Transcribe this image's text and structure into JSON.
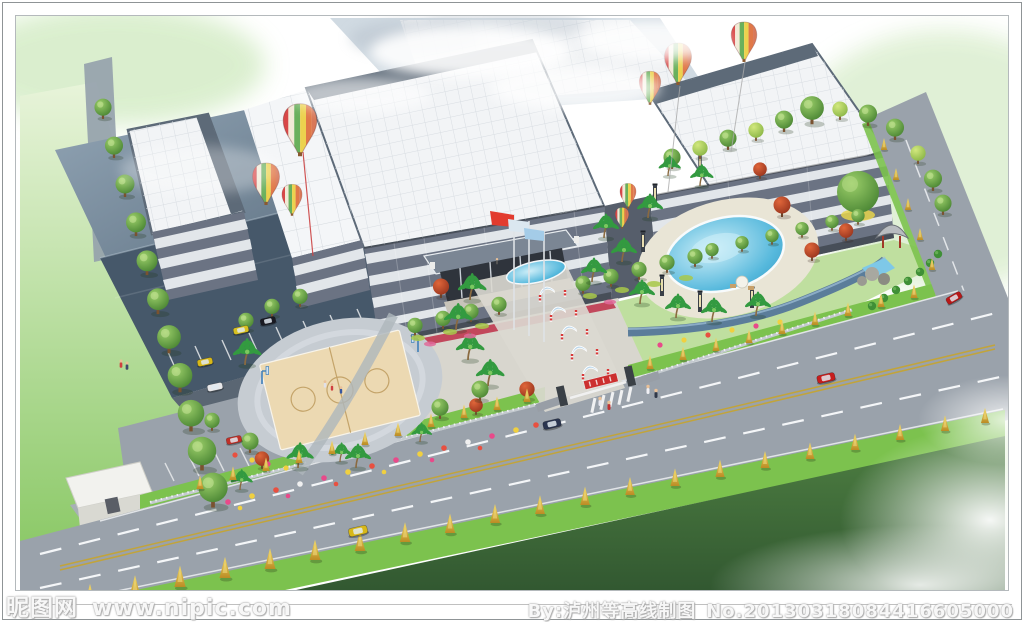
{
  "image": {
    "kind": "architectural aerial rendering of a factory campus with landscaped gardens",
    "width": 1024,
    "height": 622
  },
  "watermark": {
    "left_brand": "昵图网",
    "left_url": "www.nipic.com",
    "right_credit": "By:泸州等高线制图",
    "right_serial": "No.20130318084416605000"
  },
  "scene": {
    "elements": [
      "white panel factory roofs with dark parapets",
      "dark slate warehouse roofs (top left)",
      "five-story office facade with glass bands and entrance portico",
      "flag poles with red and light-blue flags",
      "striped hot-air balloon decorations",
      "central landscaped axis with oval fountain pond, arches and bollard lamps",
      "circular basketball court plaza with two hoops",
      "swimming pool garden with palms, red maples, gazebo and rockery",
      "parking lot with parked cars and stall lines",
      "white gatehouse at site entrance",
      "perimeter rows of round green trees",
      "main road with yellow center line, white dashes, cars and pedestrians",
      "green verges with yellow columnar trees",
      "dark green embankment fading into mist"
    ],
    "colors": {
      "background": "#ffffff",
      "sky_green": "#d6ecc6",
      "slate_roof": "#4c5f70",
      "panel_roof": "#f2f4f6",
      "roof_frame": "#5d6a78",
      "facade_glass": "#6b7484",
      "facade_band": "#e2e6ea",
      "road": "#9aa2ab",
      "lane_yellow": "#c2a43a",
      "verge_green": "#7cc24e",
      "lawn": "#b9e09a",
      "slope_green": "#3c6b38",
      "pool_water": "#57bade",
      "deck": "#e9e5d6",
      "court": "#ecd9b2",
      "plaza": "#d8d6ce",
      "tree_green": "#3d7a2b",
      "palm_green": "#2e8b3a",
      "autumn_tree": "#d8b23c",
      "maple_red": "#b84427",
      "flower_pink": "#e84a8a",
      "flower_yellow": "#f0d040",
      "flag_red": "#e23b2e",
      "flag_blue": "#a4cce8",
      "car_taxi": "#d8b818",
      "car_red": "#c81e1e",
      "car_dark": "#2a3550"
    }
  }
}
